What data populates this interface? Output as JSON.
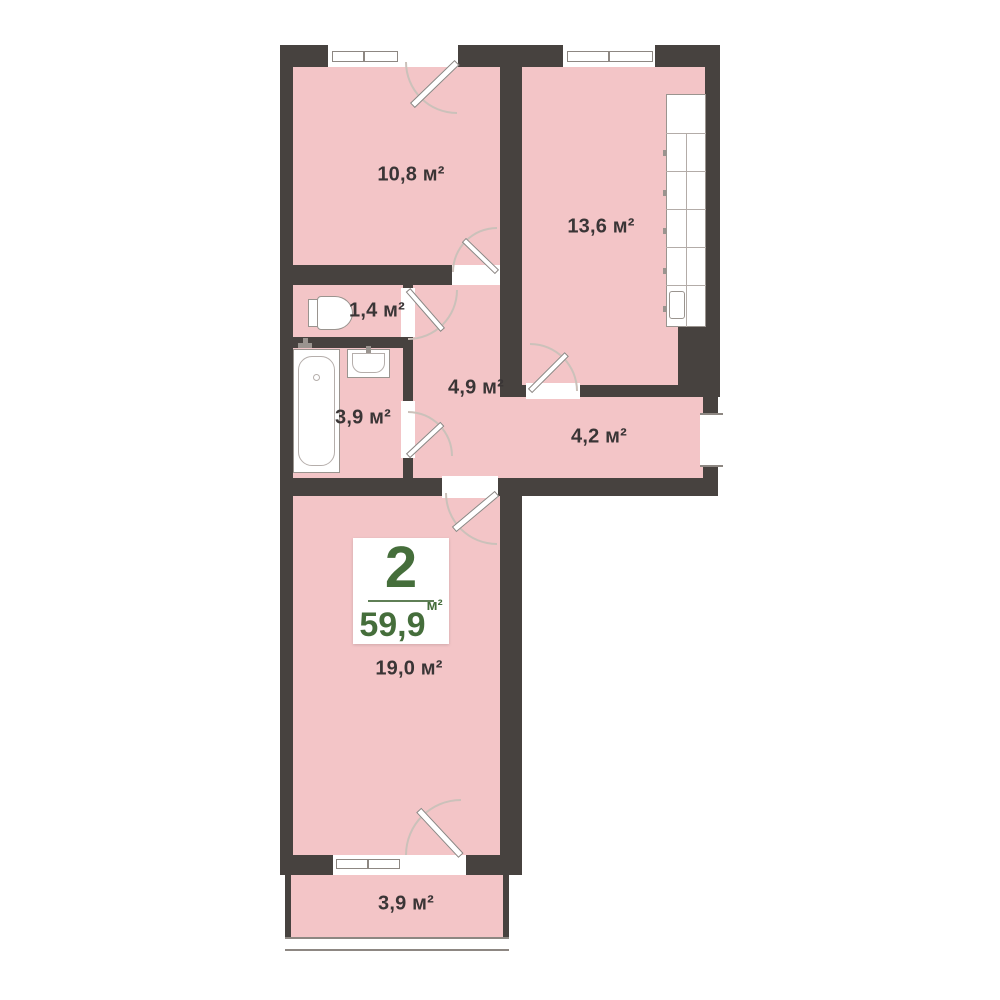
{
  "palette": {
    "wall": "#47423f",
    "room_fill": "#f3c5c7",
    "accent_green": "#456e3b",
    "label_text": "#3a3536",
    "fixture_border": "#9a948f",
    "background": "#ffffff"
  },
  "badge": {
    "rooms_number": "2",
    "total_area": "59,9",
    "area_unit": "м²"
  },
  "rooms": [
    {
      "id": "bedroom",
      "label": "10,8 м²"
    },
    {
      "id": "kitchen",
      "label": "13,6 м²"
    },
    {
      "id": "wc",
      "label": "1,4 м²"
    },
    {
      "id": "bathroom",
      "label": "3,9 м²"
    },
    {
      "id": "hallway",
      "label": "4,9 м²"
    },
    {
      "id": "corridor",
      "label": "4,2 м²"
    },
    {
      "id": "living",
      "label": "19,0 м²"
    },
    {
      "id": "balcony",
      "label": "3,9 м²"
    }
  ]
}
